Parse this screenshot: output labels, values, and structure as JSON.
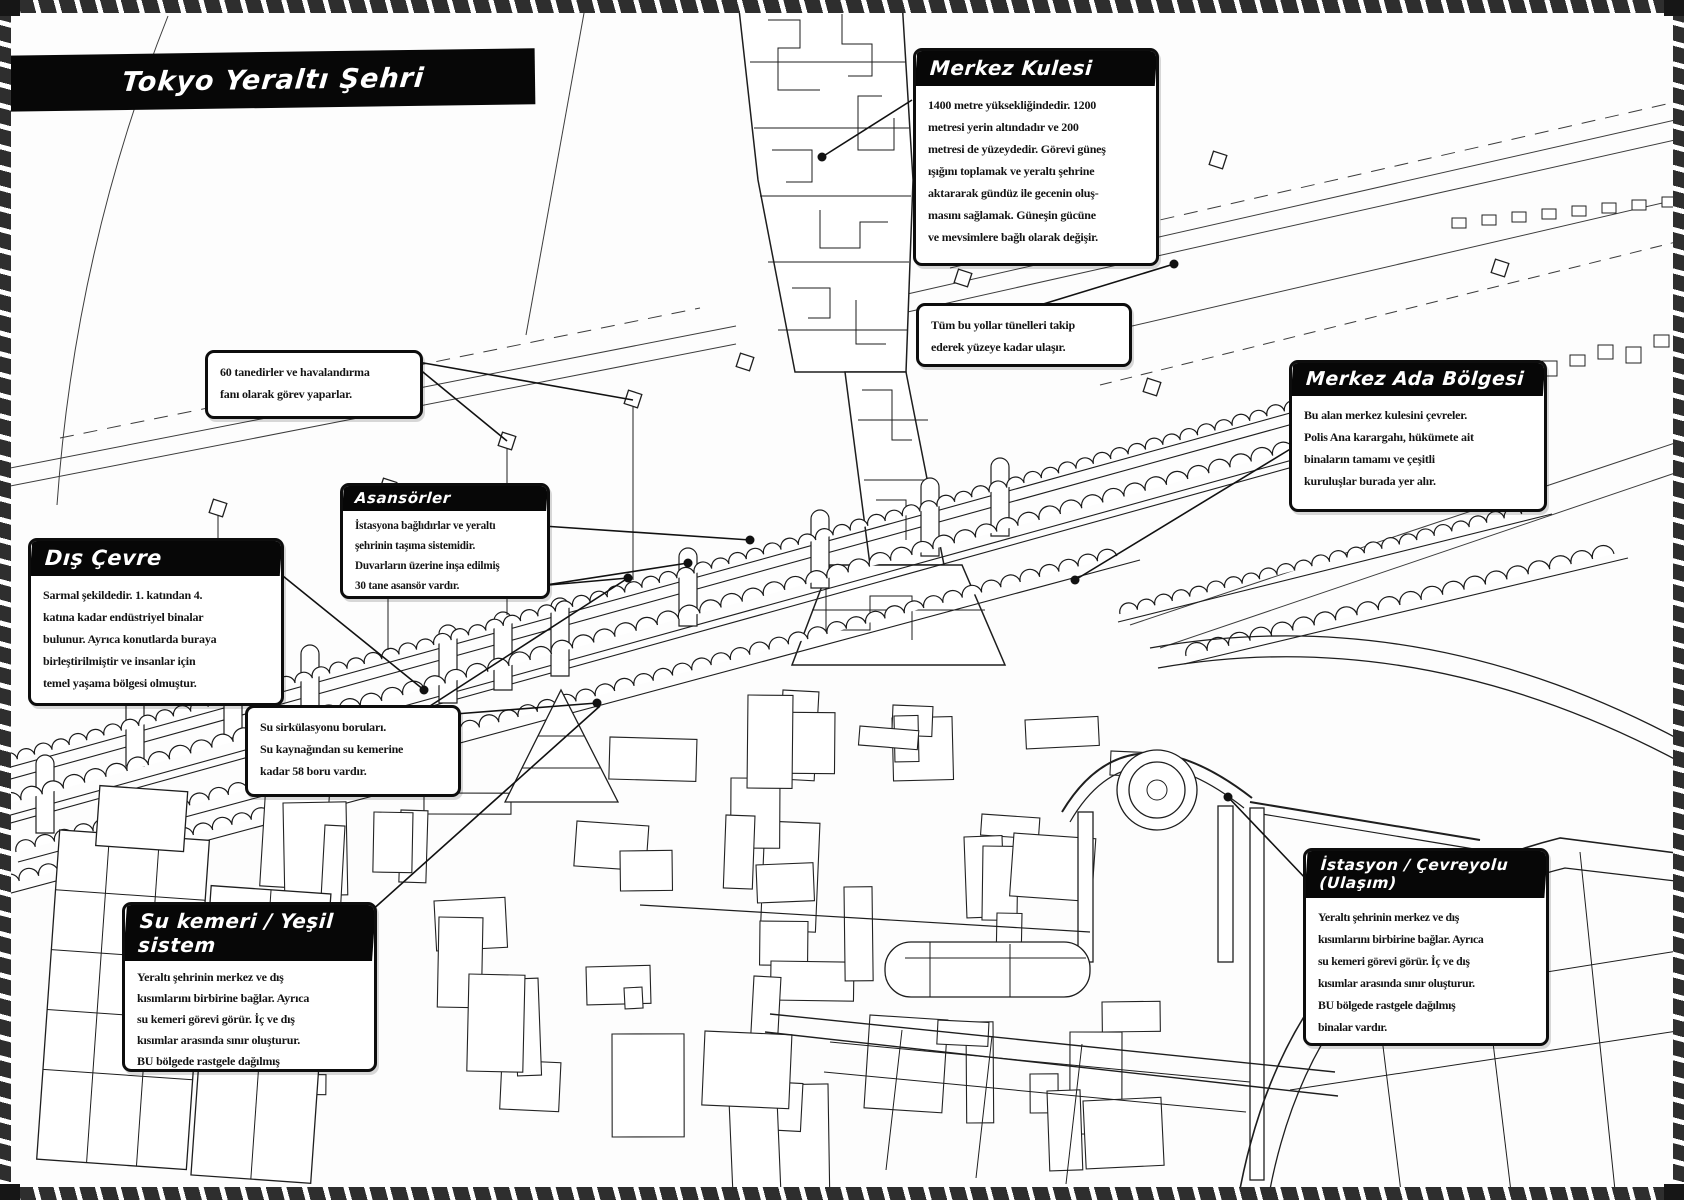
{
  "page_title": "Tokyo Yeraltı Şehri",
  "callouts": {
    "merkez_kulesi": {
      "title": "Merkez Kulesi",
      "body": "1400 metre yüksekliğindedir. 1200\nmetresi yerin altındadır ve 200\nmetresi de yüzeydedir. Görevi güneş\nışığını toplamak ve yeraltı şehrine\naktararak gündüz ile gecenin oluş-\nmasını sağlamak. Güneşin gücüne\nve mevsimlere bağlı olarak değişir."
    },
    "tunnel_note": {
      "body": "Tüm bu yollar tünelleri takip\nederek yüzeye kadar ulaşır."
    },
    "merkez_ada": {
      "title": "Merkez Ada Bölgesi",
      "body": "Bu alan merkez kulesini çevreler.\nPolis Ana karargahı, hükümete ait\nbinaların tamamı ve çeşitli\nkuruluşlar burada yer alır."
    },
    "fan_note": {
      "body": "60 tanedirler ve havalandırma\nfanı olarak görev yaparlar."
    },
    "asansorler": {
      "title": "Asansörler",
      "body": "İstasyona bağlıdırlar ve yeraltı\nşehrinin taşıma sistemidir.\nDuvarların üzerine inşa edilmiş\n30 tane asansör vardır."
    },
    "dis_cevre": {
      "title": "Dış Çevre",
      "body": "Sarmal şekildedir. 1. katından 4.\nkatına kadar endüstriyel binalar\nbulunur. Ayrıca konutlarda buraya\nbirleştirilmiştir ve insanlar için\ntemel yaşama bölgesi olmuştur."
    },
    "su_sirkulasyonu": {
      "body": "Su sirkülasyonu boruları.\nSu kaynağından su kemerine\nkadar 58 boru vardır."
    },
    "su_kemeri": {
      "title": "Su kemeri / Yeşil sistem",
      "body": "Yeraltı şehrinin merkez ve dış\nkısımlarını birbirine bağlar. Ayrıca\nsu kemeri görevi görür. İç ve dış\nkısımlar arasında sınır oluşturur.\nBU bölgede rastgele dağılmış\nbinalar vardır."
    },
    "istasyon": {
      "title": "İstasyon / Çevreyolu (Ulaşım)",
      "body": "Yeraltı şehrinin merkez ve dış\nkısımlarını birbirine bağlar. Ayrıca\nsu kemeri görevi görür. İç ve dış\nkısımlar arasında sınır oluşturur.\nBU bölgede rastgele dağılmış\nbinalar vardır."
    }
  },
  "colors": {
    "ink": "#1a1a1a",
    "paper": "#ffffff",
    "banner": "#070707"
  }
}
